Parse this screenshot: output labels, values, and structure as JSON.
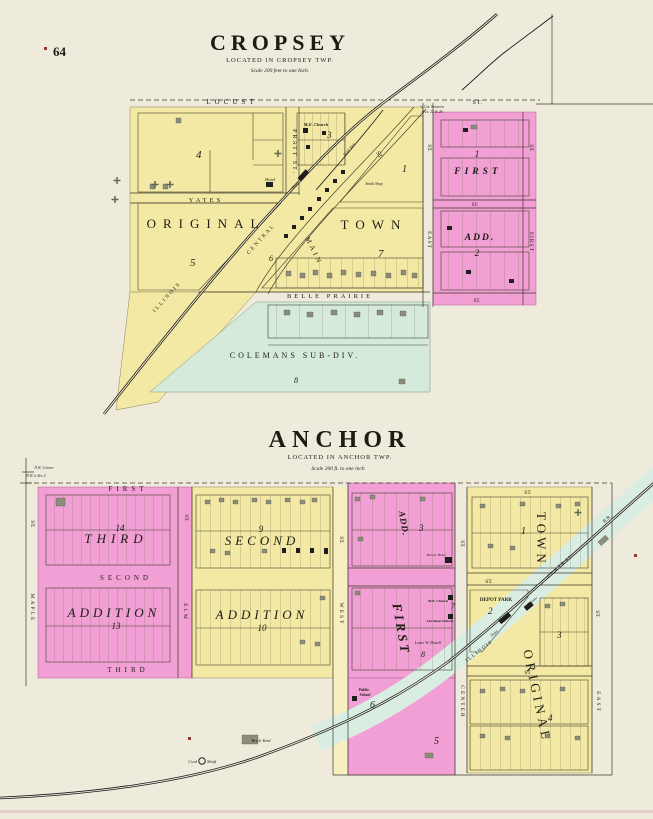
{
  "page": {
    "number": "64"
  },
  "cropsey": {
    "title": "CROPSEY",
    "located": "LOCATED IN CROPSEY TWP.",
    "scale": "Scale 200 feet to one Inch.",
    "corner_note_line1": "¼ Cor. between",
    "corner_note_line2": "Secs. 25 & 26",
    "streets": {
      "locust": "LOCUST",
      "locust_st": "ST.",
      "pratt": "PRATT ST.",
      "yates": "YATES",
      "belle_prairie": "BELLE PRAIRIE",
      "main": "MAIN",
      "main_st": "ST.",
      "east": "EAST",
      "east_st": "ST.",
      "first": "FIRST",
      "first_st": "ST.",
      "add_st_mid": "ST.",
      "add_st_bottom": "ST."
    },
    "areas": {
      "original": "ORIGINAL",
      "town": "TOWN",
      "first_add": "FIRST",
      "add": "ADD.",
      "colemans": "COLEMANS SUB-DIV."
    },
    "railroad": {
      "illinois": "ILLINOIS",
      "central": "CENTRAL"
    },
    "blocks": {
      "b1": "1",
      "b3": "3",
      "b4": "4",
      "b5": "5",
      "b6": "6",
      "b7": "7",
      "b8": "8",
      "fa1": "1",
      "fa2": "2"
    },
    "buildings": {
      "me_church": "M.E. Church",
      "hotel": "Hotel",
      "depot": "Depot",
      "smith_shop": "Smith Shop",
      "stock_yard": "Stock Yard"
    }
  },
  "anchor": {
    "title": "ANCHOR",
    "located": "LOCATED IN ANCHOR TWP.",
    "scale": "Scale 200 ft. to one inch",
    "corner_note_line1": "N.W. Corner",
    "corner_note_line2": "N.W.¼ Sec.2",
    "streets": {
      "first": "FIRST",
      "second": "SECOND",
      "third": "THIRD",
      "maple": "MAPLE",
      "maple_st": "ST.",
      "elm": "ELM",
      "elm_st": "ST.",
      "west": "WEST",
      "west_st": "ST.",
      "center": "CENTER",
      "center_st": "ST.",
      "east": "EAST",
      "east_st": "ST.",
      "st_top": "ST.",
      "st_mid": "ST.",
      "st_lower": "ST."
    },
    "areas": {
      "third": "THIRD",
      "third_addition": "ADDITION",
      "second": "SECOND",
      "second_addition": "ADDITION",
      "first_add_first": "FIRST",
      "first_add_add": "ADD.",
      "town": "TOWN",
      "original": "ORIGINAL",
      "depot_park": "DEPOT PARK"
    },
    "railroad": {
      "illinois": "ILLINOIS",
      "central": "CENTRAL",
      "rr": "R.R."
    },
    "blocks": {
      "b14": "14",
      "b13": "13",
      "b9": "9",
      "b10": "10",
      "b3_first": "3",
      "b7": "7",
      "b8": "8",
      "b1": "1",
      "b2": "2",
      "b3_orig": "3",
      "b4": "4",
      "b5": "5",
      "b6": "6"
    },
    "buildings": {
      "hotel": "Harvey Hotel",
      "me_church": "M.E. Church",
      "christian_church": "Christian Church",
      "dazell": "Louis W. Dazell",
      "school_line1": "Public",
      "school_line2": "School",
      "depot": "Depot",
      "elevator": "Elevator",
      "brick_yard": "Brick Yard",
      "coal": "Coal",
      "shaft": "Shaft"
    }
  }
}
